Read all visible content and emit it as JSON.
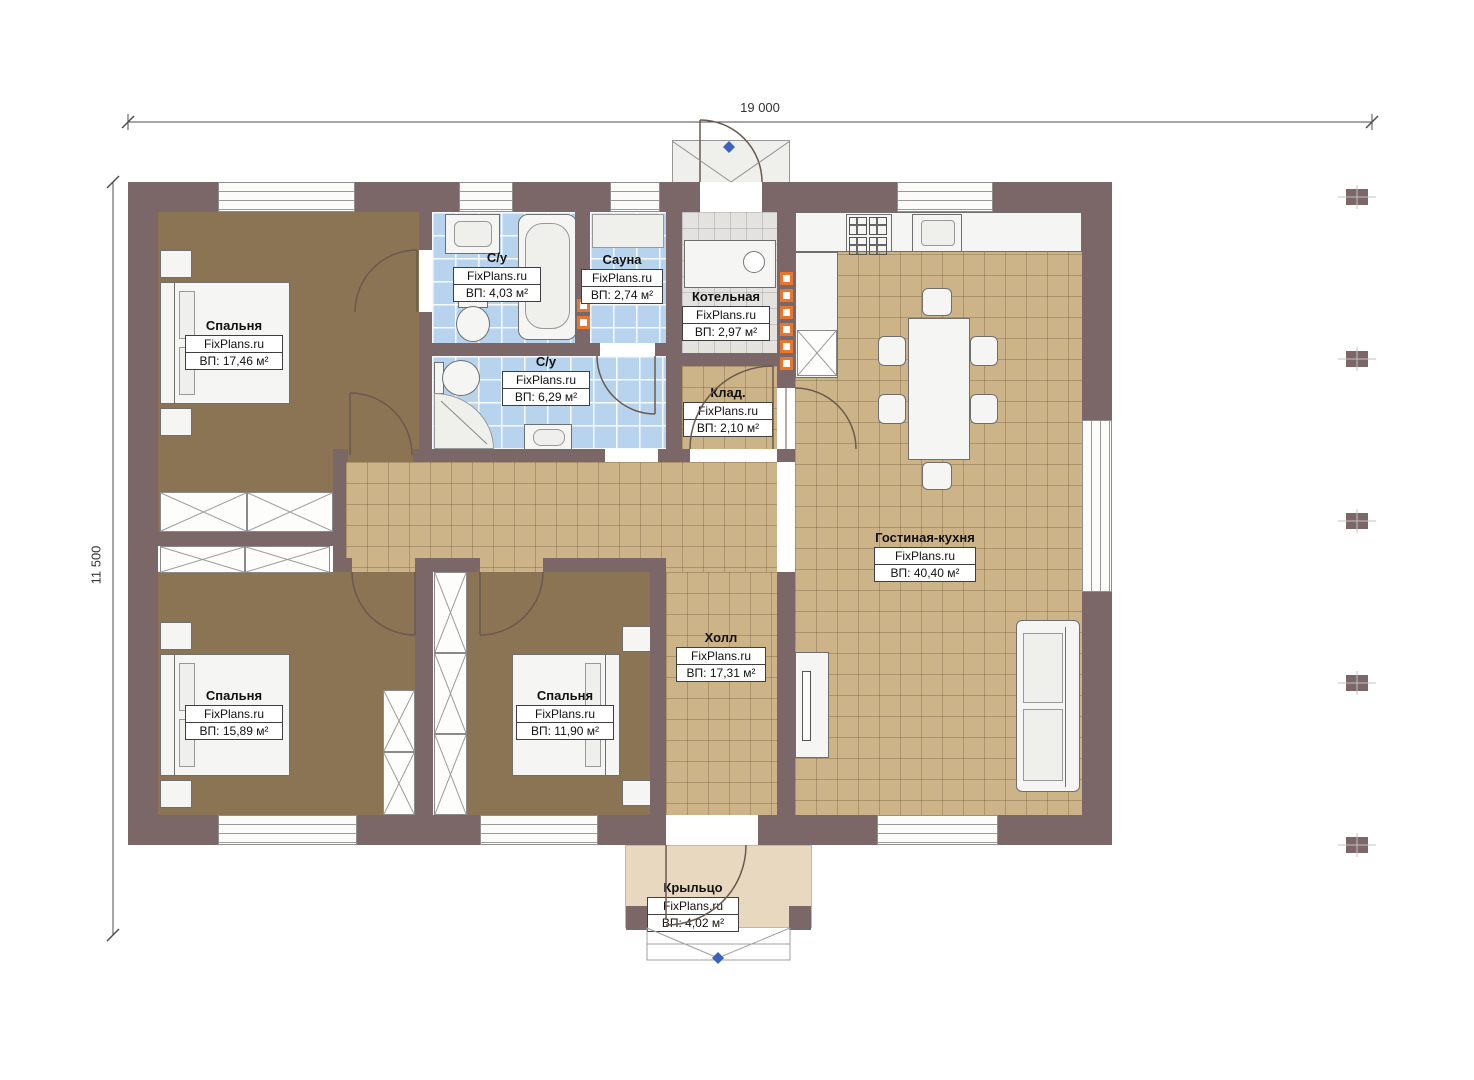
{
  "meta": {
    "watermark": "FixPlans.ru"
  },
  "dimensions": {
    "width_label": "19 000",
    "height_label": "11 500"
  },
  "rooms": {
    "bedroom1": {
      "name": "Спальня",
      "area": "ВП: 17,46 м²"
    },
    "bath1": {
      "name": "С/у",
      "area": "ВП: 4,03 м²"
    },
    "sauna": {
      "name": "Сауна",
      "area": "ВП: 2,74 м²"
    },
    "boiler": {
      "name": "Котельная",
      "area": "ВП: 2,97 м²"
    },
    "bath2": {
      "name": "С/у",
      "area": "ВП: 6,29 м²"
    },
    "storage": {
      "name": "Клад.",
      "area": "ВП: 2,10 м²"
    },
    "living": {
      "name": "Гостиная-кухня",
      "area": "ВП: 40,40 м²"
    },
    "hall": {
      "name": "Холл",
      "area": "ВП: 17,31 м²"
    },
    "bedroom2": {
      "name": "Спальня",
      "area": "ВП: 15,89 м²"
    },
    "bedroom3": {
      "name": "Спальня",
      "area": "ВП: 11,90 м²"
    },
    "porch": {
      "name": "Крыльцо",
      "area": "ВП: 4,02 м²"
    }
  },
  "colors": {
    "wall": "#7b6767",
    "floor_brown": "#8a7453",
    "floor_tile_tan": "#cdb488",
    "floor_tile_blue": "#b7d3ee",
    "floor_tile_grey": "#e4e2df",
    "floor_porch": "#e9d8c0",
    "heater_orange": "#e8762c",
    "marker_blue": "#3c62c0"
  }
}
